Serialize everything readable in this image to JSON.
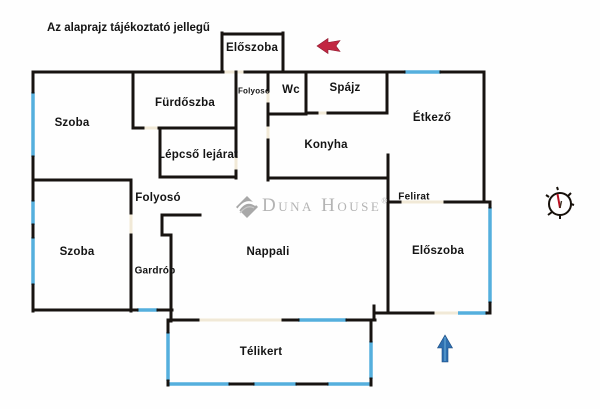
{
  "note": "Az alaprajz tájékoztató jellegű",
  "rooms": {
    "eloszoba_top": "Előszoba",
    "furdoszoba": "Fürdőszba",
    "folyoso_upper": "Folyosó",
    "wc": "Wc",
    "spajz": "Spájz",
    "szoba_upper": "Szoba",
    "etkezo": "Étkező",
    "lepcso_lejarat": "Lépcső lejárat",
    "konyha": "Konyha",
    "folyoso_middle": "Folyosó",
    "felirat": "Felirat",
    "szoba_lower": "Szoba",
    "gardrob": "Gardrób",
    "nappali": "Nappali",
    "eloszoba_right": "Előszoba",
    "telikert": "Télikert"
  },
  "watermark": {
    "brand": "Duna House",
    "registered": "®"
  },
  "icons": {
    "red_left_arrow": "left-arrow-icon",
    "blue_up_arrow": "up-arrow-icon",
    "compass": "compass-icon",
    "brand_diamond": "brand-diamond-icon"
  },
  "colors": {
    "wall": "#171310",
    "window": "#55afdd",
    "door_opening": "#f1e9d7",
    "arrow_red": "#c22742",
    "arrow_blue": "#2e6fb0",
    "compass_needle": "#bb1122",
    "watermark_gray": "#b4b4b4"
  }
}
